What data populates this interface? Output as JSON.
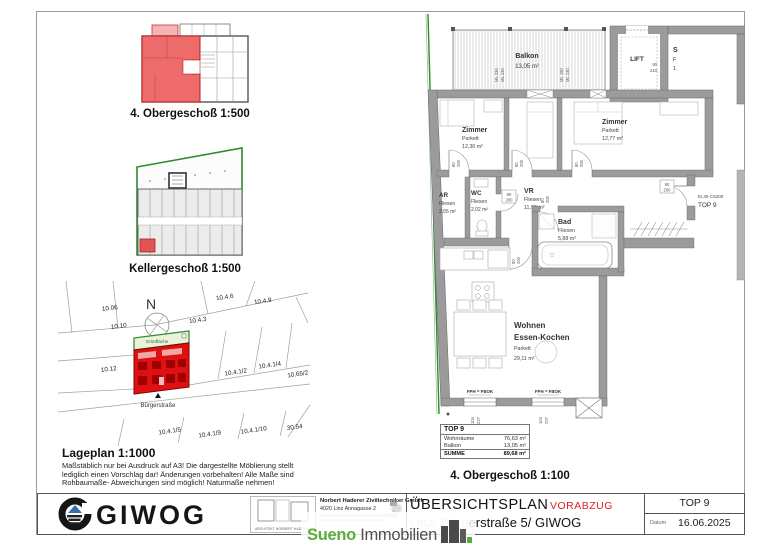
{
  "captions": {
    "og500": "4. Obergeschoß 1:500",
    "kg500": "Kellergeschoß 1:500",
    "lageplan": "Lageplan 1:1000",
    "og100": "4. Obergeschoß 1:100"
  },
  "note_lines": [
    "Maßstäblich nur bei Ausdruck auf A3! Die dargestellte Möblierung stellt",
    "lediglich einen Vorschlag dar! Änderungen vorbehalten! Alle Maße sind",
    "Rohbaumaße- Abweichungen sind möglich! Naturmaße nehmen!"
  ],
  "siteplan": {
    "north": "N",
    "gruenflaeche": "Grünfläche",
    "street": "Bürgerstraße",
    "parcels": [
      "10.06",
      "10.4.6",
      "10.4.9",
      "10.10",
      "10.4.3",
      "10.12",
      "10.4.1/2",
      "10.4.1/4",
      "10.65/2",
      "10.4.1/5",
      "10.4.1/9",
      "10.4.1/10",
      "30.54"
    ]
  },
  "floorplan": {
    "rooms": {
      "zimmer1": {
        "name": "Zimmer",
        "floor": "Parkett",
        "area": "12,30 m²"
      },
      "zimmer2": {
        "name": "Zimmer",
        "floor": "Parkett",
        "area": "12,77 m²"
      },
      "ar": {
        "name": "AR",
        "floor": "Fliesen",
        "area": "2,65 m²"
      },
      "wc": {
        "name": "WC",
        "floor": "Fliesen",
        "area": "2,02 m²"
      },
      "vr": {
        "name": "VR",
        "floor": "Fliesen",
        "area": "11,90 m²"
      },
      "bad": {
        "name": "Bad",
        "floor": "Fliesen",
        "area": "5,88 m²"
      },
      "living": {
        "name1": "Wohnen",
        "name2": "Essen-Kochen",
        "floor": "Parkett",
        "area": "29,11 m²"
      },
      "balkon": {
        "name": "Balkon",
        "area": "13,05 m²"
      },
      "lift": {
        "name": "LIFT"
      }
    },
    "dims": {
      "ml": [
        "ML 230",
        "ML 230",
        "ML 190",
        "ML 230"
      ],
      "door_w": "80",
      "door_h": "200",
      "wide_w": "90",
      "lift_w": "90",
      "lift_h": "210",
      "entry_w": "90",
      "entry_h": "200",
      "entry_class": "EI,30-CS200",
      "entry_unit": "TOP 9",
      "win_w": "104",
      "win_h": "227",
      "fph": "FPH = FBOK",
      "stair": [
        "S",
        "F",
        "1"
      ]
    }
  },
  "summary": {
    "title": "TOP 9",
    "rows": [
      {
        "label": "Wohnräume",
        "value": "76,63 m²"
      },
      {
        "label": "Balkon",
        "value": "13,05 m²"
      }
    ],
    "total_label": "SUMME",
    "total_value": "89,68 m²"
  },
  "titleblock": {
    "brand": "GIWOG",
    "architect_box_caption": "ARCHITEKT NORBERT HADERER",
    "firm_name": "Norbert Haderer Ziviltechniker GmbH",
    "firm_address": "4020 Linz  Annagasse 2",
    "doc_title": "ÜBERSICHTSPLAN",
    "status": "VORABZUG",
    "address_prefix": "Linz, Bürg",
    "address_suffix": "erstraße 5/ GIWOG",
    "unit": "TOP 9",
    "date_label": "Datum",
    "date_value": "16.06.2025"
  },
  "watermark": {
    "word1": "Sueno",
    "word2": " Immobilien"
  }
}
